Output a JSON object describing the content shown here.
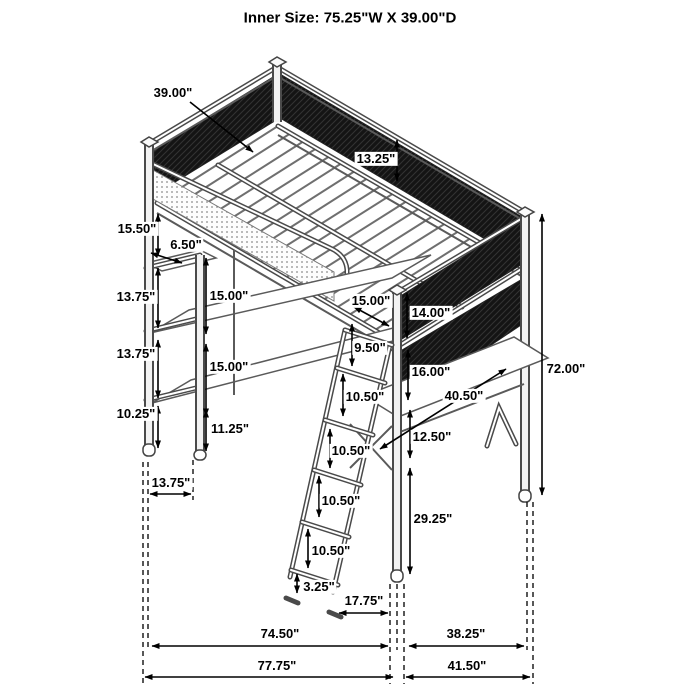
{
  "title": "Inner Size: 75.25\"W X 39.00\"D",
  "dim_labels": {
    "bed_depth": "39.00\"",
    "guard_rail_height": "13.25\"",
    "left_gap_top": "15.50\"",
    "top_shelf_depth": "6.50\"",
    "left_gap_mid1": "13.75\"",
    "shelf_gap_upper": "15.00\"",
    "left_gap_mid2": "13.75\"",
    "shelf_gap_lower": "15.00\"",
    "left_gap_bottom": "10.25\"",
    "lower_shelf_height": "11.25\"",
    "left_leg_offset": "13.75\"",
    "ladder_opening": "15.00\"",
    "upper_mesh_height": "14.00\"",
    "ladder_top_gap": "9.50\"",
    "ladder_rung_1": "10.50\"",
    "lower_mesh_height": "16.00\"",
    "desk_length": "40.50\"",
    "desk_gap": "12.50\"",
    "ladder_rung_2": "10.50\"",
    "ladder_rung_3": "10.50\"",
    "ladder_rung_4": "10.50\"",
    "ladder_foot": "3.25\"",
    "ladder_spread": "17.75\"",
    "desk_height": "29.25\"",
    "total_height": "72.00\"",
    "frame_width": "74.50\"",
    "desk_depth": "38.25\"",
    "total_width": "77.75\"",
    "total_depth": "41.50\""
  }
}
